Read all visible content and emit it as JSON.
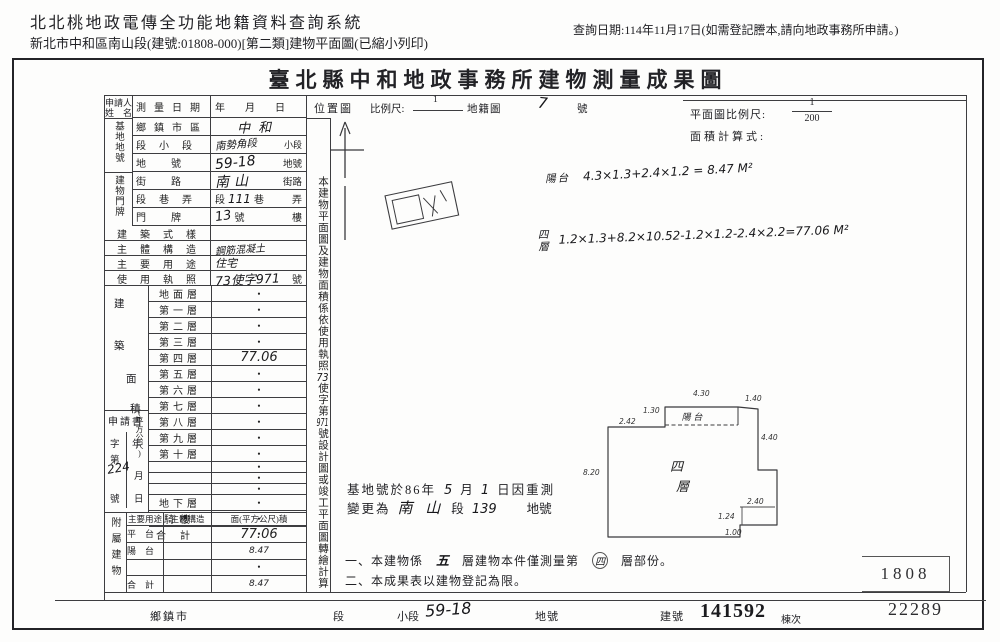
{
  "header": {
    "system_title": "北北桃地政電傳全功能地籍資料查詢系統",
    "subtitle": "新北市中和區南山段(建號:01808-000)[第二類]建物平面圖(已縮小列印)",
    "query_date": "查詢日期:114年11月17日(如需登記謄本,請向地政事務所申請。)"
  },
  "title": "臺北縣中和地政事務所建物測量成果圖",
  "form": {
    "applicant": {
      "l1": "申請人",
      "l2": "姓　名"
    },
    "groups": {
      "base": "基地地號",
      "building": "建物門牌",
      "annex": "附屬建物",
      "area_unit": "(平方公尺)"
    },
    "area_chars": [
      "建",
      "築",
      "面",
      "積"
    ],
    "survey": {
      "label": "測量日期",
      "value": "年　　月　　日"
    },
    "township": {
      "label": "鄉鎮市區",
      "value": "中和"
    },
    "section": {
      "label": "段小段",
      "value": "南勢角段",
      "suffix": "小段"
    },
    "parcel": {
      "label": "地號",
      "value": "59-18",
      "suffix": "地號"
    },
    "street": {
      "label": "街路",
      "value": "南山",
      "suffix": "街路"
    },
    "lane": {
      "label": "段巷弄",
      "pre": "段",
      "value": "111",
      "mid": "巷",
      "suffix": "弄"
    },
    "plate": {
      "label": "門牌",
      "value": "13",
      "mid": "號",
      "suffix": "樓"
    },
    "style": {
      "label": "建築式樣",
      "value": ""
    },
    "structure": {
      "label": "主體構造",
      "value": "鋼筋混凝土"
    },
    "usage": {
      "label": "主要用途",
      "value": "住宅"
    },
    "license": {
      "label": "使用執照",
      "value": "73使字971",
      "suffix": "號"
    },
    "floors": [
      {
        "label": "地面層",
        "value": "•"
      },
      {
        "label": "第一層",
        "value": "•"
      },
      {
        "label": "第二層",
        "value": "•"
      },
      {
        "label": "第三層",
        "value": "•"
      },
      {
        "label": "第四層",
        "value": "77.06"
      },
      {
        "label": "第五層",
        "value": "•"
      },
      {
        "label": "第六層",
        "value": "•"
      },
      {
        "label": "第七層",
        "value": "•"
      },
      {
        "label": "第八層",
        "value": "•"
      },
      {
        "label": "第九層",
        "value": "•"
      },
      {
        "label": "第十層",
        "value": "•"
      },
      {
        "label": "",
        "value": "•"
      },
      {
        "label": "",
        "value": "•"
      },
      {
        "label": "",
        "value": "•"
      },
      {
        "label": "地下層",
        "value": "•"
      },
      {
        "label": "騎樓",
        "value": "•"
      },
      {
        "label": "合計",
        "value": "77.06"
      }
    ],
    "application": {
      "title": "申請書",
      "zi": "字",
      "di": "第",
      "hao": "號",
      "nian": "年",
      "yue": "月",
      "ri": "日",
      "hw": "224"
    },
    "annex": {
      "headers": [
        "主要用途",
        "主體構造",
        "面(平方公尺)積"
      ],
      "rows": [
        {
          "label": "平台",
          "value": "•"
        },
        {
          "label": "陽台",
          "value": "8.47"
        },
        {
          "label": "",
          "value": "•"
        },
        {
          "label": "合計",
          "value": "8.47"
        }
      ]
    }
  },
  "vnote": {
    "p1": "本建物平面圖及建物面積係依使用執照",
    "h1": "73",
    "p2": "使字第",
    "h2": "971",
    "p3": "號設計圖或竣工平面圖轉繪計算"
  },
  "loc": {
    "label": "位置圖",
    "scale_label": "比例尺:",
    "num": "1",
    "cadastral": "地籍圖",
    "hw_no": "7",
    "suffix": "號"
  },
  "pscale": {
    "label": "平面圖比例尺:",
    "num": "1",
    "den": "200",
    "calc_label": "面積計算式:"
  },
  "formulas": {
    "balcony_label": "陽台",
    "balcony": "4.3×1.3+2.4×1.2 = 8.47 M²",
    "floor4_l1": "四",
    "floor4_l2": "層",
    "floor4": "1.2×1.3+8.2×10.52-1.2×1.2-2.4×2.2=77.06 M²"
  },
  "plan": {
    "balcony": "陽 台",
    "room1": "四",
    "room2": "層",
    "dims": {
      "top": "4.30",
      "top_right": "1.40",
      "balcony_left": "1.30",
      "top_left": "2.42",
      "right": "4.40",
      "left": "8.20",
      "notch_top": "2.40",
      "notch_left": "1.24",
      "notch_bottom": "1.00"
    }
  },
  "resurvey": {
    "p1": "基地號於86年",
    "h1": "5",
    "p2": "月",
    "h2": "1",
    "p3": "日因重測",
    "p4": "變更為",
    "h3": "南 山",
    "p5": "段",
    "h4": "139",
    "p6": "地號"
  },
  "notes": {
    "n1a": "一、本建物係",
    "n1hw": "五",
    "n1b": "層建物本件僅測量第",
    "n1hw2": "四",
    "n1c": "層部份。",
    "n2": "二、本成果表以建物登記為限。"
  },
  "stamp": "1808",
  "footer": {
    "township_label": "鄉鎮市",
    "section_label": "段",
    "subsection_label": "小段",
    "subsection_value": "59-18",
    "parcel_label": "地號",
    "building_no_label": "建號",
    "building_no": "141592",
    "unit_label": "棟次",
    "serial": "22289"
  }
}
